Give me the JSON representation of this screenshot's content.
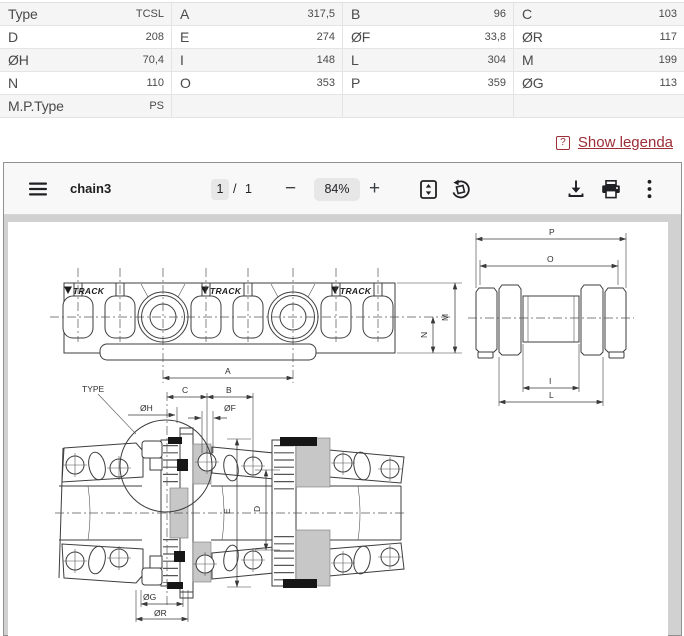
{
  "table": {
    "rows": [
      [
        {
          "label": "Type",
          "value": "TCSL"
        },
        {
          "label": "A",
          "value": "317,5"
        },
        {
          "label": "B",
          "value": "96"
        },
        {
          "label": "C",
          "value": "103"
        }
      ],
      [
        {
          "label": "D",
          "value": "208"
        },
        {
          "label": "E",
          "value": "274"
        },
        {
          "label": "ØF",
          "value": "33,8"
        },
        {
          "label": "ØR",
          "value": "117"
        }
      ],
      [
        {
          "label": "ØH",
          "value": "70,4"
        },
        {
          "label": "I",
          "value": "148"
        },
        {
          "label": "L",
          "value": "304"
        },
        {
          "label": "M",
          "value": "199"
        }
      ],
      [
        {
          "label": "N",
          "value": "110"
        },
        {
          "label": "O",
          "value": "353"
        },
        {
          "label": "P",
          "value": "359"
        },
        {
          "label": "ØG",
          "value": "113"
        }
      ],
      [
        {
          "label": "M.P.Type",
          "value": "PS"
        },
        null,
        null,
        null
      ]
    ]
  },
  "legend": {
    "icon": "?",
    "label": "Show legenda",
    "color": "#9d2d36"
  },
  "viewer": {
    "toolbar": {
      "title": "chain3",
      "page_current": "1",
      "page_separator": "/",
      "page_total": "1",
      "zoom_out": "−",
      "zoom_level": "84%",
      "zoom_in": "+",
      "icons": {
        "menu": "hamburger",
        "fit": "fit-page",
        "rotate": "rotate-ccw",
        "download": "download",
        "print": "print",
        "more": "kebab-menu"
      }
    }
  },
  "drawing": {
    "brand": "VTRACK",
    "logo_text": "TRACK",
    "labels": {
      "A": "A",
      "B": "B",
      "C": "C",
      "D": "D",
      "E": "E",
      "I": "I",
      "L": "L",
      "M": "M",
      "N": "N",
      "O": "O",
      "P": "P",
      "TYPE": "TYPE",
      "OH": "ØH",
      "OF": "ØF",
      "OG": "ØG",
      "OR": "ØR"
    }
  }
}
